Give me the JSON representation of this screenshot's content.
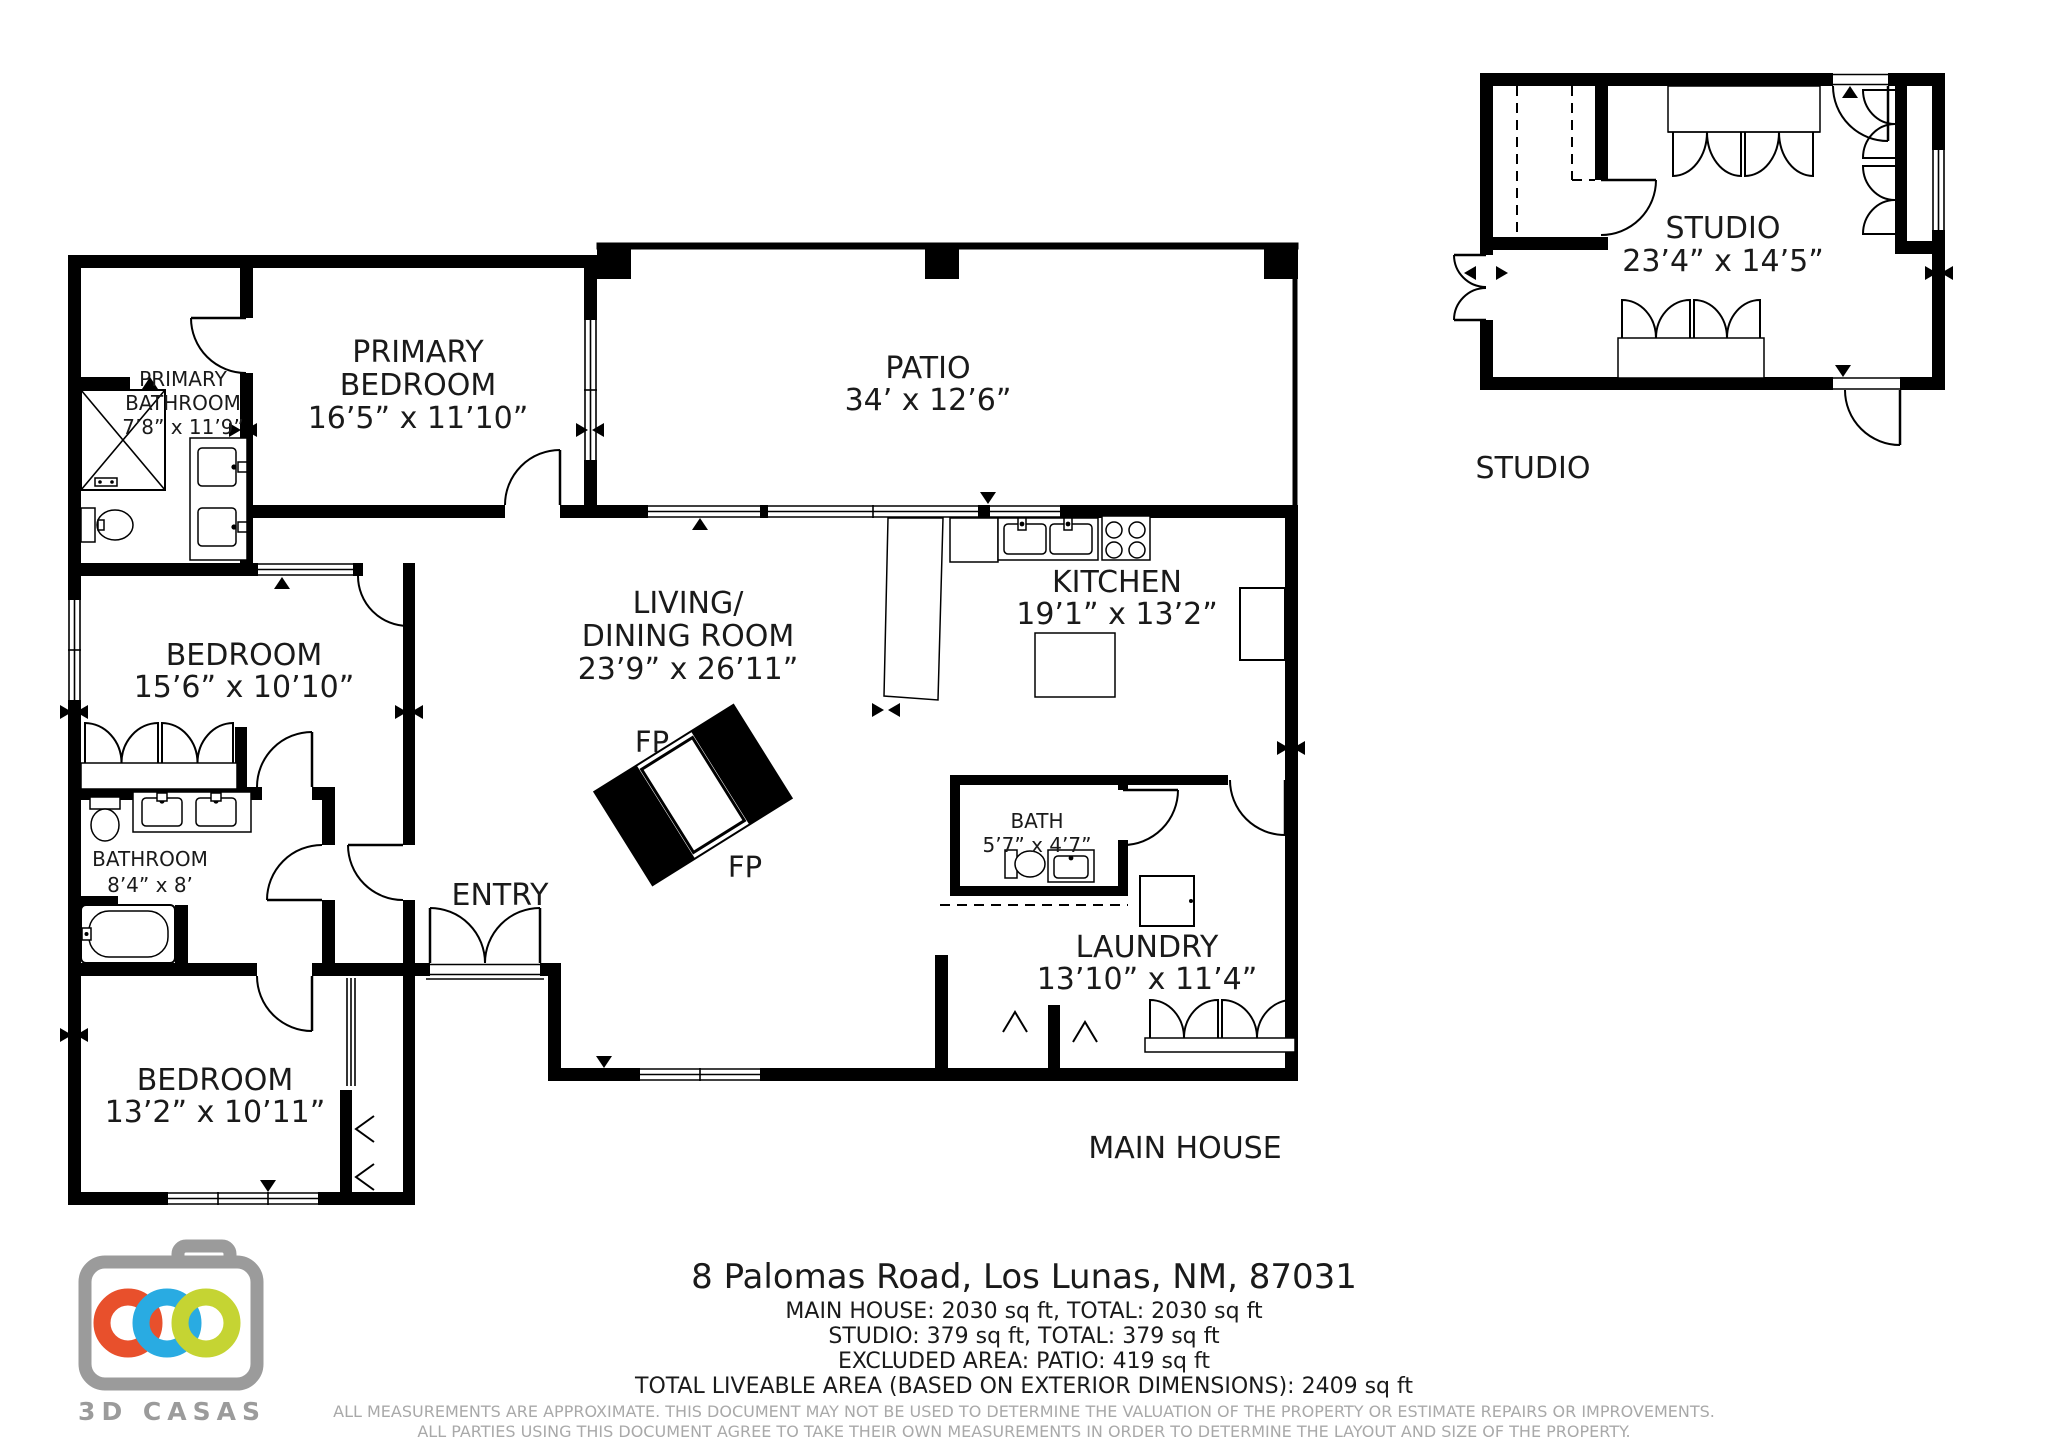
{
  "colors": {
    "wall": "#000000",
    "text": "#1a1a1a",
    "disclaimer_gray": "#a9a9a9",
    "logo_gray": "#9b9b9b",
    "logo_orange": "#e8502c",
    "logo_blue": "#29abe2",
    "logo_green": "#c5d433"
  },
  "main_house": {
    "caption": "MAIN HOUSE",
    "rooms": {
      "primary_bathroom": {
        "name_line1": "PRIMARY",
        "name_line2": "BATHROOM",
        "dims": "7’8” x 11’9”"
      },
      "primary_bedroom": {
        "name_line1": "PRIMARY",
        "name_line2": "BEDROOM",
        "dims": "16’5” x 11’10”"
      },
      "patio": {
        "name": "PATIO",
        "dims": "34’ x 12’6”"
      },
      "living_dining": {
        "name_line1": "LIVING/",
        "name_line2": "DINING ROOM",
        "dims": "23’9” x 26’11”"
      },
      "kitchen": {
        "name": "KITCHEN",
        "dims": "19’1” x 13’2”"
      },
      "bedroom_west": {
        "name": "BEDROOM",
        "dims": "15’6” x 10’10”"
      },
      "bathroom": {
        "name": "BATHROOM",
        "dims": "8’4” x 8’"
      },
      "entry": {
        "name": "ENTRY"
      },
      "bath": {
        "name": "BATH",
        "dims": "5’7” x 4’7”"
      },
      "laundry": {
        "name": "LAUNDRY",
        "dims": "13’10” x 11’4”"
      },
      "bedroom_south": {
        "name": "BEDROOM",
        "dims": "13’2” x 10’11”"
      },
      "fireplace": {
        "label": "FP"
      }
    }
  },
  "studio": {
    "caption": "STUDIO",
    "room": {
      "name": "STUDIO",
      "dims": "23’4” x 14’5”"
    }
  },
  "footer": {
    "address": "8 Palomas Road, Los Lunas, NM, 87031",
    "areas": [
      "MAIN HOUSE: 2030 sq ft, TOTAL: 2030 sq ft",
      "STUDIO: 379 sq ft, TOTAL: 379 sq ft",
      "EXCLUDED AREA: PATIO: 419 sq ft",
      "TOTAL LIVEABLE AREA (BASED ON EXTERIOR DIMENSIONS): 2409 sq ft"
    ],
    "disclaimers": [
      "ALL MEASUREMENTS ARE APPROXIMATE. THIS DOCUMENT MAY NOT BE USED TO DETERMINE THE VALUATION OF THE PROPERTY OR ESTIMATE REPAIRS OR IMPROVEMENTS.",
      "ALL PARTIES USING THIS DOCUMENT AGREE TO TAKE THEIR OWN MEASUREMENTS IN ORDER TO DETERMINE THE LAYOUT AND SIZE OF THE PROPERTY."
    ]
  },
  "logo": {
    "brand": "3D CASAS"
  }
}
